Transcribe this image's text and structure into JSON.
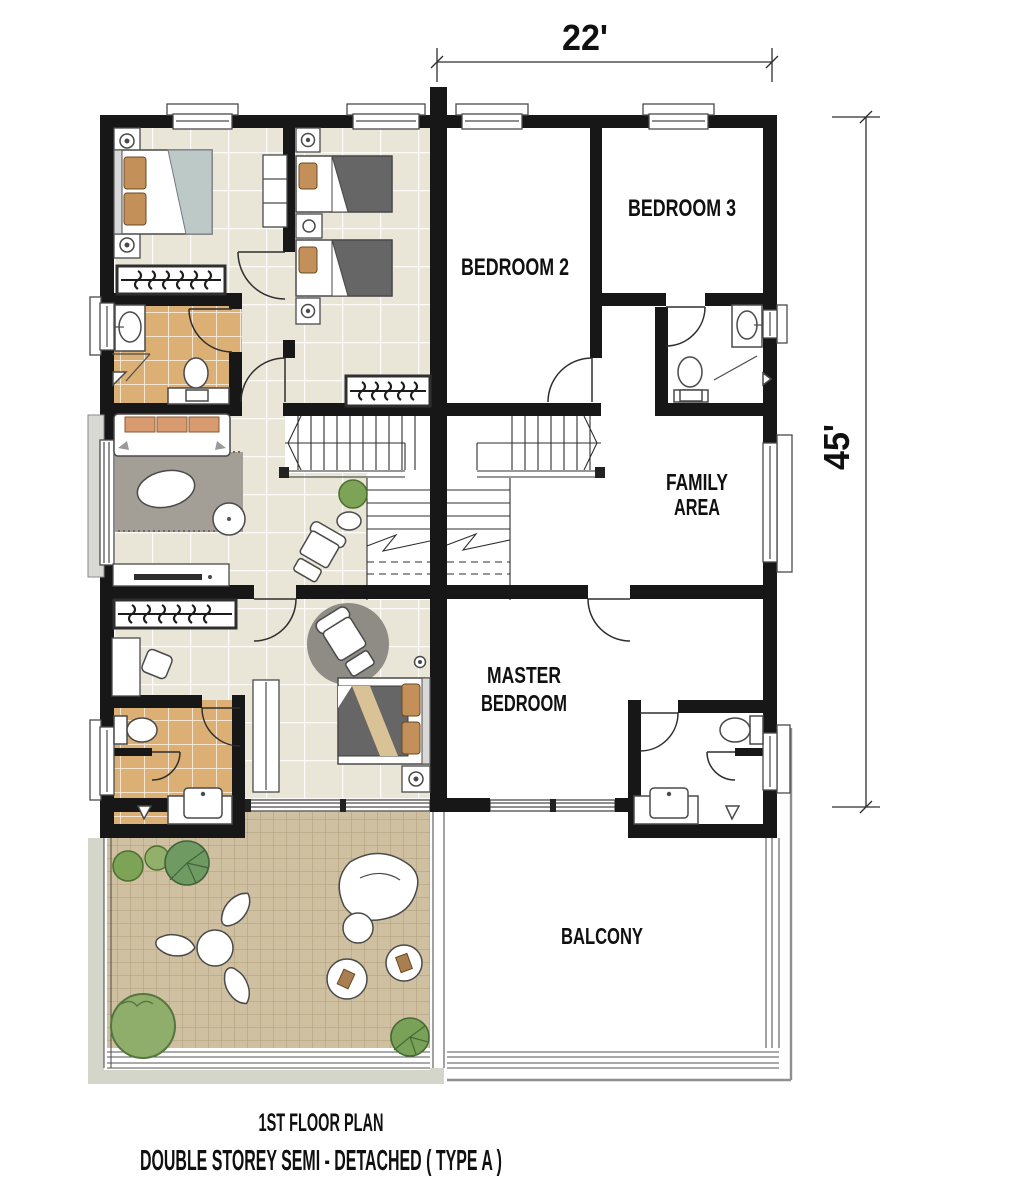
{
  "plan": {
    "dimension_width": "22'",
    "dimension_depth": "45'",
    "rooms": {
      "bedroom2": "BEDROOM 2",
      "bedroom3": "BEDROOM 3",
      "family_line1": "FAMILY",
      "family_line2": "AREA",
      "master_line1": "MASTER",
      "master_line2": "BEDROOM",
      "balcony": "BALCONY"
    },
    "title_line1": "1ST FLOOR PLAN",
    "title_line2": "DOUBLE STOREY SEMI - DETACHED ( TYPE A )",
    "colors": {
      "wall": "#171717",
      "floor_tile": "#e9e6d7",
      "bath_tile": "#dcb074",
      "balcony_tile": "#cec0a0",
      "rug": "#a39f97",
      "round_rug": "#8f8b85",
      "sofa_cushion": "#d89b6f",
      "blanket": "#666666",
      "blanket_stripe": "#d9c296",
      "pillow": "#c29058",
      "plant": "#7da456",
      "shadow_band": "#d3d6c9",
      "glass_panel": "#d9d9d4"
    }
  }
}
